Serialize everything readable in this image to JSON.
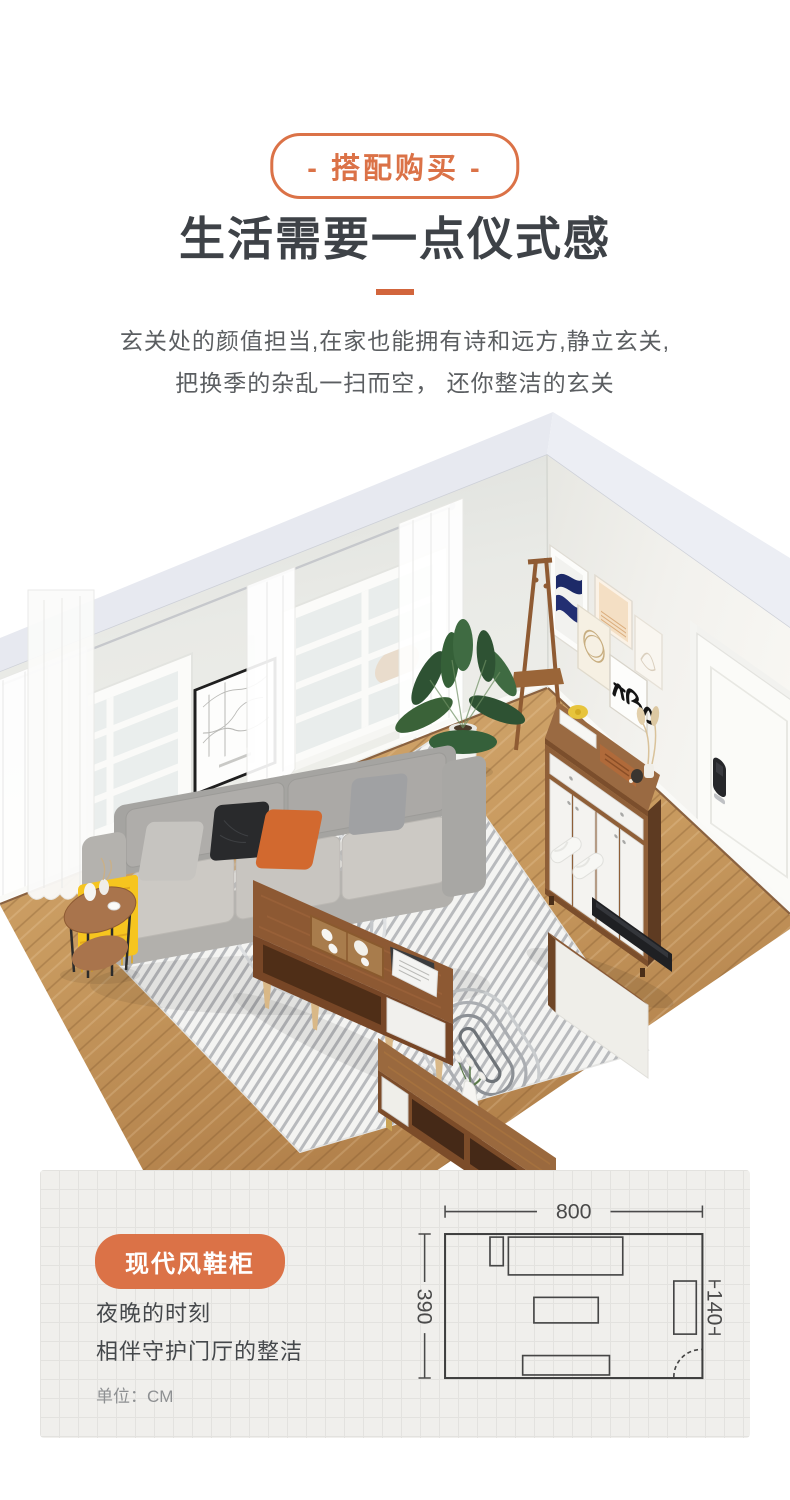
{
  "colors": {
    "accent_orange": "#DB7247",
    "divider_orange": "#D2653C",
    "heading_text": "#3E4247",
    "body_text": "#5B5E61",
    "panel_bg": "#F0EFEC",
    "plan_line": "#3F3F3F",
    "unit_text": "#8E9092"
  },
  "header": {
    "badge_label": "- 搭配购买 -",
    "title": "生活需要一点仪式感",
    "subtitle_line1": "玄关处的颜值担当,在家也能拥有诗和远方,静立玄关,",
    "subtitle_line2": "把换季的杂乱一扫而空， 还你整洁的玄关"
  },
  "room_scene": {
    "items": [
      "windows",
      "curtains",
      "map-art",
      "gallery-wall-art",
      "coat-rack",
      "plant",
      "shoe-cabinet",
      "entry-door",
      "smart-lock",
      "slippers",
      "gray-sofa",
      "pillows",
      "yellow-throw",
      "side-table",
      "striped-arch-rug",
      "coffee-table",
      "tea-tray",
      "tv-panel-stand",
      "tv",
      "tv-bench",
      "wood-floor"
    ]
  },
  "product_panel": {
    "badge_label": "现代风鞋柜",
    "caption_line1": "夜晚的时刻",
    "caption_line2": "相伴守护门厅的整洁",
    "unit_label": "单位：CM",
    "floor_plan": {
      "width_label": "800",
      "depth_label": "390",
      "cabinet_label": "140"
    }
  }
}
